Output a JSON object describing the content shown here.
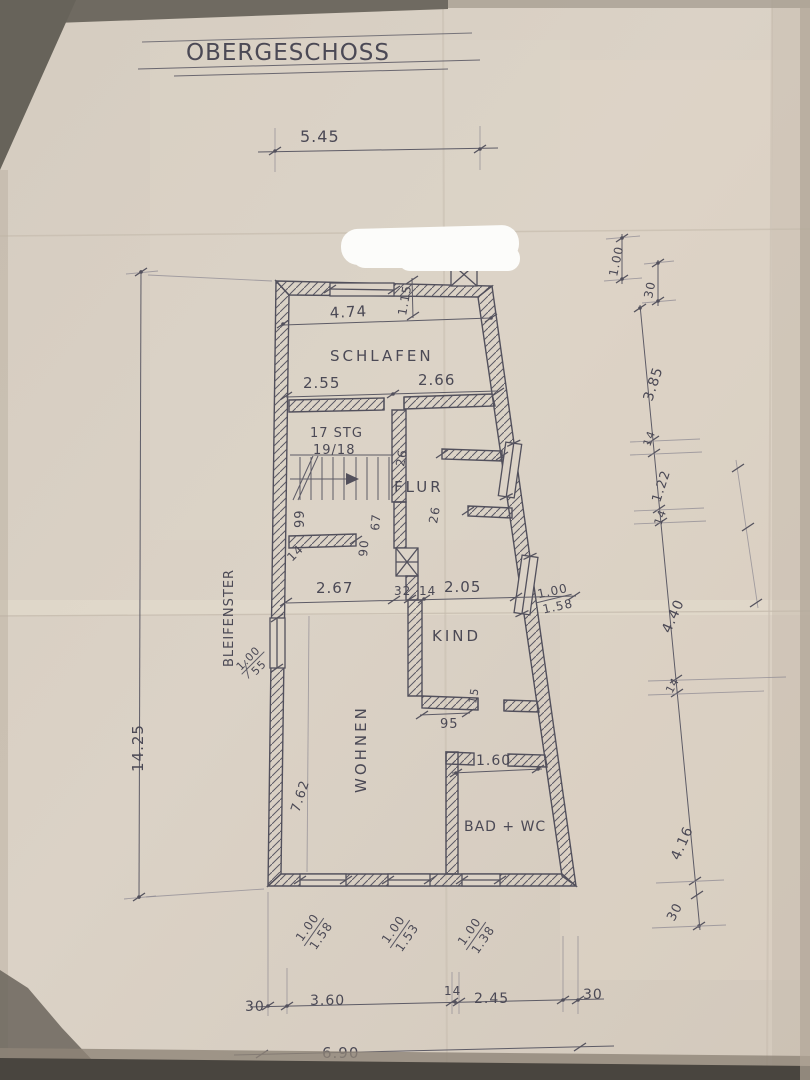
{
  "title": "OBERGESCHOSS",
  "rooms": {
    "schlafen": "SCHLAFEN",
    "flur": "FLUR",
    "kind": "KIND",
    "wohnen": "WOHNEN",
    "bad_wc": "BAD + WC"
  },
  "stairs": {
    "count": "17 STG",
    "ratio": "19/18"
  },
  "notes": {
    "bleifenster": "BLEIFENSTER"
  },
  "dims": {
    "top_width": "5.45",
    "total_height": "14.25",
    "upper_inner_width": "4.74",
    "top_recess": "1.15",
    "schlafen_left": "2.55",
    "schlafen_right": "2.66",
    "tr_height": "1.00",
    "tr_offset": "30",
    "right_1": "3.85",
    "right_2": "14",
    "right_3": "1.22",
    "right_4": "14",
    "right_5": "4.40",
    "right_6": "14",
    "right_7": "4.16",
    "right_8": "30",
    "shelf_top": "26",
    "shelf_bottom": "26",
    "flur_h1": "99",
    "flur_h2": "67",
    "flur_h3": "90",
    "flur_h4": "14",
    "mid_1": "2.67",
    "mid_2": "32",
    "mid_3": "14",
    "mid_4": "2.05",
    "kind_wall": "15",
    "kind_door": "95",
    "bad_width": "1.60",
    "wohnen_height": "7.62",
    "bottom_1": "30",
    "bottom_2": "3.60",
    "bottom_3": "14",
    "bottom_4": "2.45",
    "bottom_5": "30",
    "bottom_total": "6.90"
  },
  "windows": {
    "left": {
      "w": "1.00",
      "h": "55"
    },
    "kind_right": {
      "w": "1.00",
      "h": "1.58"
    },
    "bottom_1": {
      "w": "1.00",
      "h": "1.58"
    },
    "bottom_2": {
      "w": "1.00",
      "h": "1.53"
    },
    "bottom_3": {
      "w": "1.00",
      "h": "1.38"
    }
  },
  "colors": {
    "ink": "#52505c",
    "paper": "#d8cfc3"
  }
}
